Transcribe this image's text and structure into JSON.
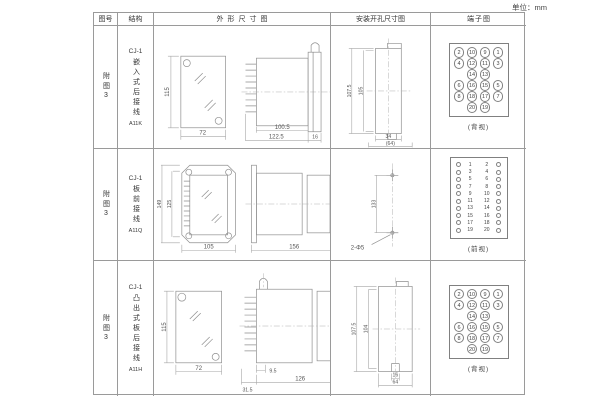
{
  "page": {
    "unit_label": "单位：mm"
  },
  "headers": [
    "图号",
    "结构",
    "外形尺寸图",
    "安装开孔尺寸图",
    "端子图"
  ],
  "rows": [
    {
      "fig_no": "附图3",
      "structure": {
        "model": "CJ-1",
        "desc": "嵌入式后接线",
        "code": "A11K"
      },
      "outline": {
        "h": "115",
        "w": "72",
        "d1": "100.5",
        "d2": "122.5",
        "d3": "16"
      },
      "cutout": {
        "h1": "107.5",
        "h2": "105",
        "w1": "34",
        "w2": "(64)"
      },
      "terminal_caption": "(背视)"
    },
    {
      "fig_no": "附图3",
      "structure": {
        "model": "CJ-1",
        "desc": "板前接线",
        "code": "A11Q"
      },
      "outline": {
        "h1": "149",
        "h2": "125",
        "w": "105",
        "d": "156",
        "bh": "115"
      },
      "cutout": {
        "spacing": "133",
        "holes": "2-Φ5"
      },
      "terminal_caption": "(前视)"
    },
    {
      "fig_no": "附图3",
      "structure": {
        "model": "CJ-1",
        "desc": "凸出式板后接线",
        "code": "A11H"
      },
      "outline": {
        "h": "115",
        "w": "72",
        "d1": "31.5",
        "d2": "9.5",
        "d3": "126"
      },
      "cutout": {
        "h1": "107.5",
        "h2": "104",
        "w1": "16",
        "w2": "64"
      },
      "terminal_caption": "(背视)"
    }
  ],
  "terminal_numbers": [
    "2",
    "10",
    "9",
    "1",
    "4",
    "12",
    "11",
    "3",
    "14",
    "13",
    "6",
    "16",
    "15",
    "5",
    "8",
    "18",
    "17",
    "7",
    "20",
    "19"
  ],
  "terminal_pairs": [
    [
      "1",
      "2"
    ],
    [
      "3",
      "4"
    ],
    [
      "5",
      "6"
    ],
    [
      "7",
      "8"
    ],
    [
      "9",
      "10"
    ],
    [
      "11",
      "12"
    ],
    [
      "13",
      "14"
    ],
    [
      "15",
      "16"
    ],
    [
      "17",
      "18"
    ],
    [
      "19",
      "20"
    ]
  ]
}
